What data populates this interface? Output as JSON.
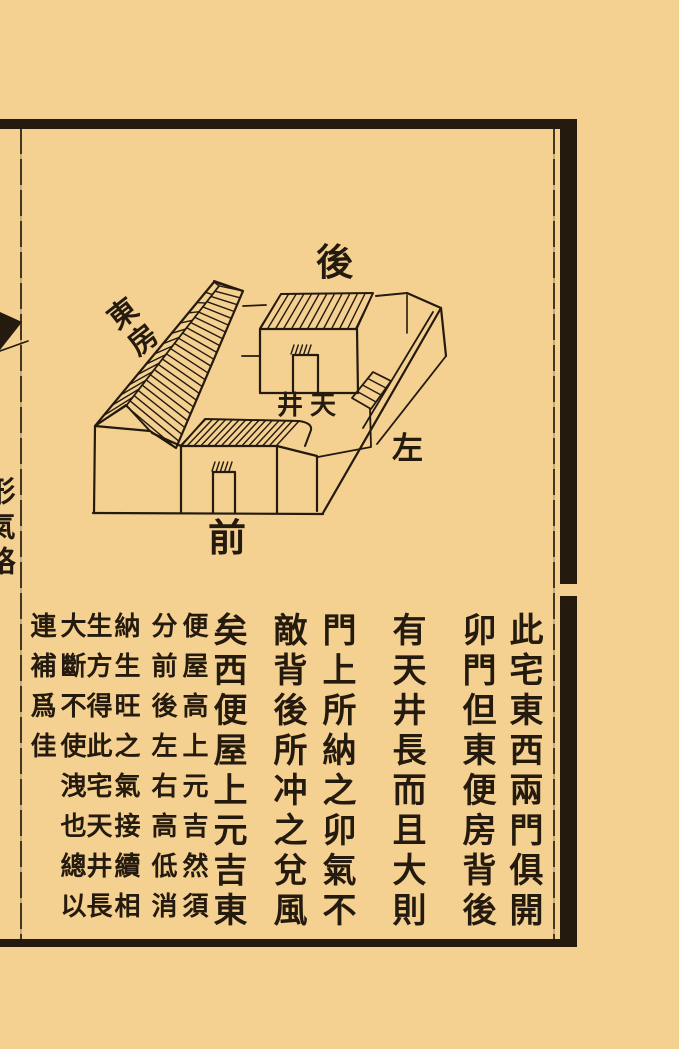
{
  "page": {
    "background_color": "#f4d091",
    "ink_color": "#241a0e"
  },
  "diagram": {
    "labels": {
      "back": "後",
      "east_room": "東房",
      "courtyard": "井天",
      "left": "左",
      "front": "前"
    }
  },
  "text_block": {
    "main_columns": [
      {
        "text": "此宅東西兩門俱開"
      },
      {
        "text": "卯門但東便房背後"
      },
      {
        "text": "有天井長而且大則"
      },
      {
        "text": "門上所納之卯氣不"
      },
      {
        "text": "敵背後所冲之兌風"
      },
      {
        "text": "矣西便屋上元吉東"
      }
    ],
    "annotation_columns": [
      {
        "text": "便屋高上元吉然須"
      },
      {
        "text": "分前後左右高低消"
      },
      {
        "text": "納生旺之氣接續相"
      },
      {
        "text": "生方得此宅天井長"
      },
      {
        "text": "大斷不使洩也總以"
      },
      {
        "text": "連補爲佳"
      }
    ],
    "margin_fragment": "形氣略"
  }
}
